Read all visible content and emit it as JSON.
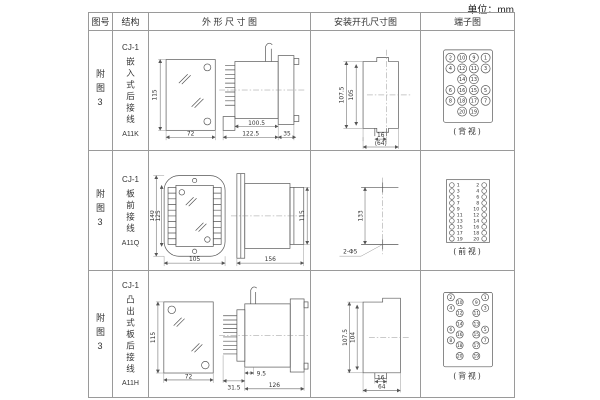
{
  "page": {
    "unit_label": "单位：mm"
  },
  "table": {
    "headers": {
      "fig": "图号",
      "structure": "结构",
      "outline": "外 形 尺 寸 图",
      "mounting": "安装开孔尺寸图",
      "terminal": "端子图"
    },
    "rows": [
      {
        "fig_no": "附图3",
        "structure": {
          "model": "CJ-1",
          "type": "嵌入式后接线",
          "code": "A11K"
        },
        "outline_dims": {
          "front_height": "115",
          "front_width": "72",
          "body_len": "100.5",
          "total_len": "122.5",
          "flange": "35"
        },
        "mounting_dims": {
          "v_outer": "107.5",
          "v_inner": "105",
          "slot_w": "16",
          "width": "(64)"
        },
        "terminal": {
          "view_label": "(背视)",
          "grid": [
            [
              "2",
              "10",
              "9",
              "1"
            ],
            [
              "4",
              "12",
              "11",
              "3"
            ],
            [
              "",
              "14",
              "13",
              ""
            ],
            [
              "6",
              "16",
              "15",
              "5"
            ],
            [
              "8",
              "18",
              "17",
              "7"
            ],
            [
              "",
              "20",
              "19",
              ""
            ]
          ]
        }
      },
      {
        "fig_no": "附图3",
        "structure": {
          "model": "CJ-1",
          "type": "板前接线",
          "code": "A11Q"
        },
        "outline_dims": {
          "front_height_outer": "140",
          "front_height_inner": "125",
          "front_width": "105",
          "side_len": "156",
          "side_height": "115"
        },
        "mounting_dims": {
          "v": "133",
          "holes": "2-Φ5"
        },
        "terminal": {
          "view_label": "(前视)",
          "left": [
            "1",
            "3",
            "5",
            "7",
            "9",
            "11",
            "13",
            "15",
            "17",
            "19"
          ],
          "right": [
            "2",
            "4",
            "6",
            "8",
            "10",
            "12",
            "14",
            "16",
            "18",
            "20"
          ]
        }
      },
      {
        "fig_no": "附图3",
        "structure": {
          "model": "CJ-1",
          "type": "凸出式板后接线",
          "code": "A11H"
        },
        "outline_dims": {
          "front_height": "115",
          "front_width": "72",
          "pins_len": "31.5",
          "step_len": "9.5",
          "body_len": "126"
        },
        "mounting_dims": {
          "v_outer": "107.5",
          "v_inner": "104",
          "slot_w": "16",
          "width": "64"
        },
        "terminal": {
          "view_label": "(背视)",
          "outer_left": [
            "2",
            "4",
            "6",
            "8"
          ],
          "inner_left": [
            "10",
            "12",
            "14",
            "16",
            "18",
            "20"
          ],
          "inner_right": [
            "9",
            "11",
            "13",
            "15",
            "17",
            "19"
          ],
          "outer_right": [
            "1",
            "3",
            "5",
            "7"
          ]
        }
      }
    ]
  }
}
